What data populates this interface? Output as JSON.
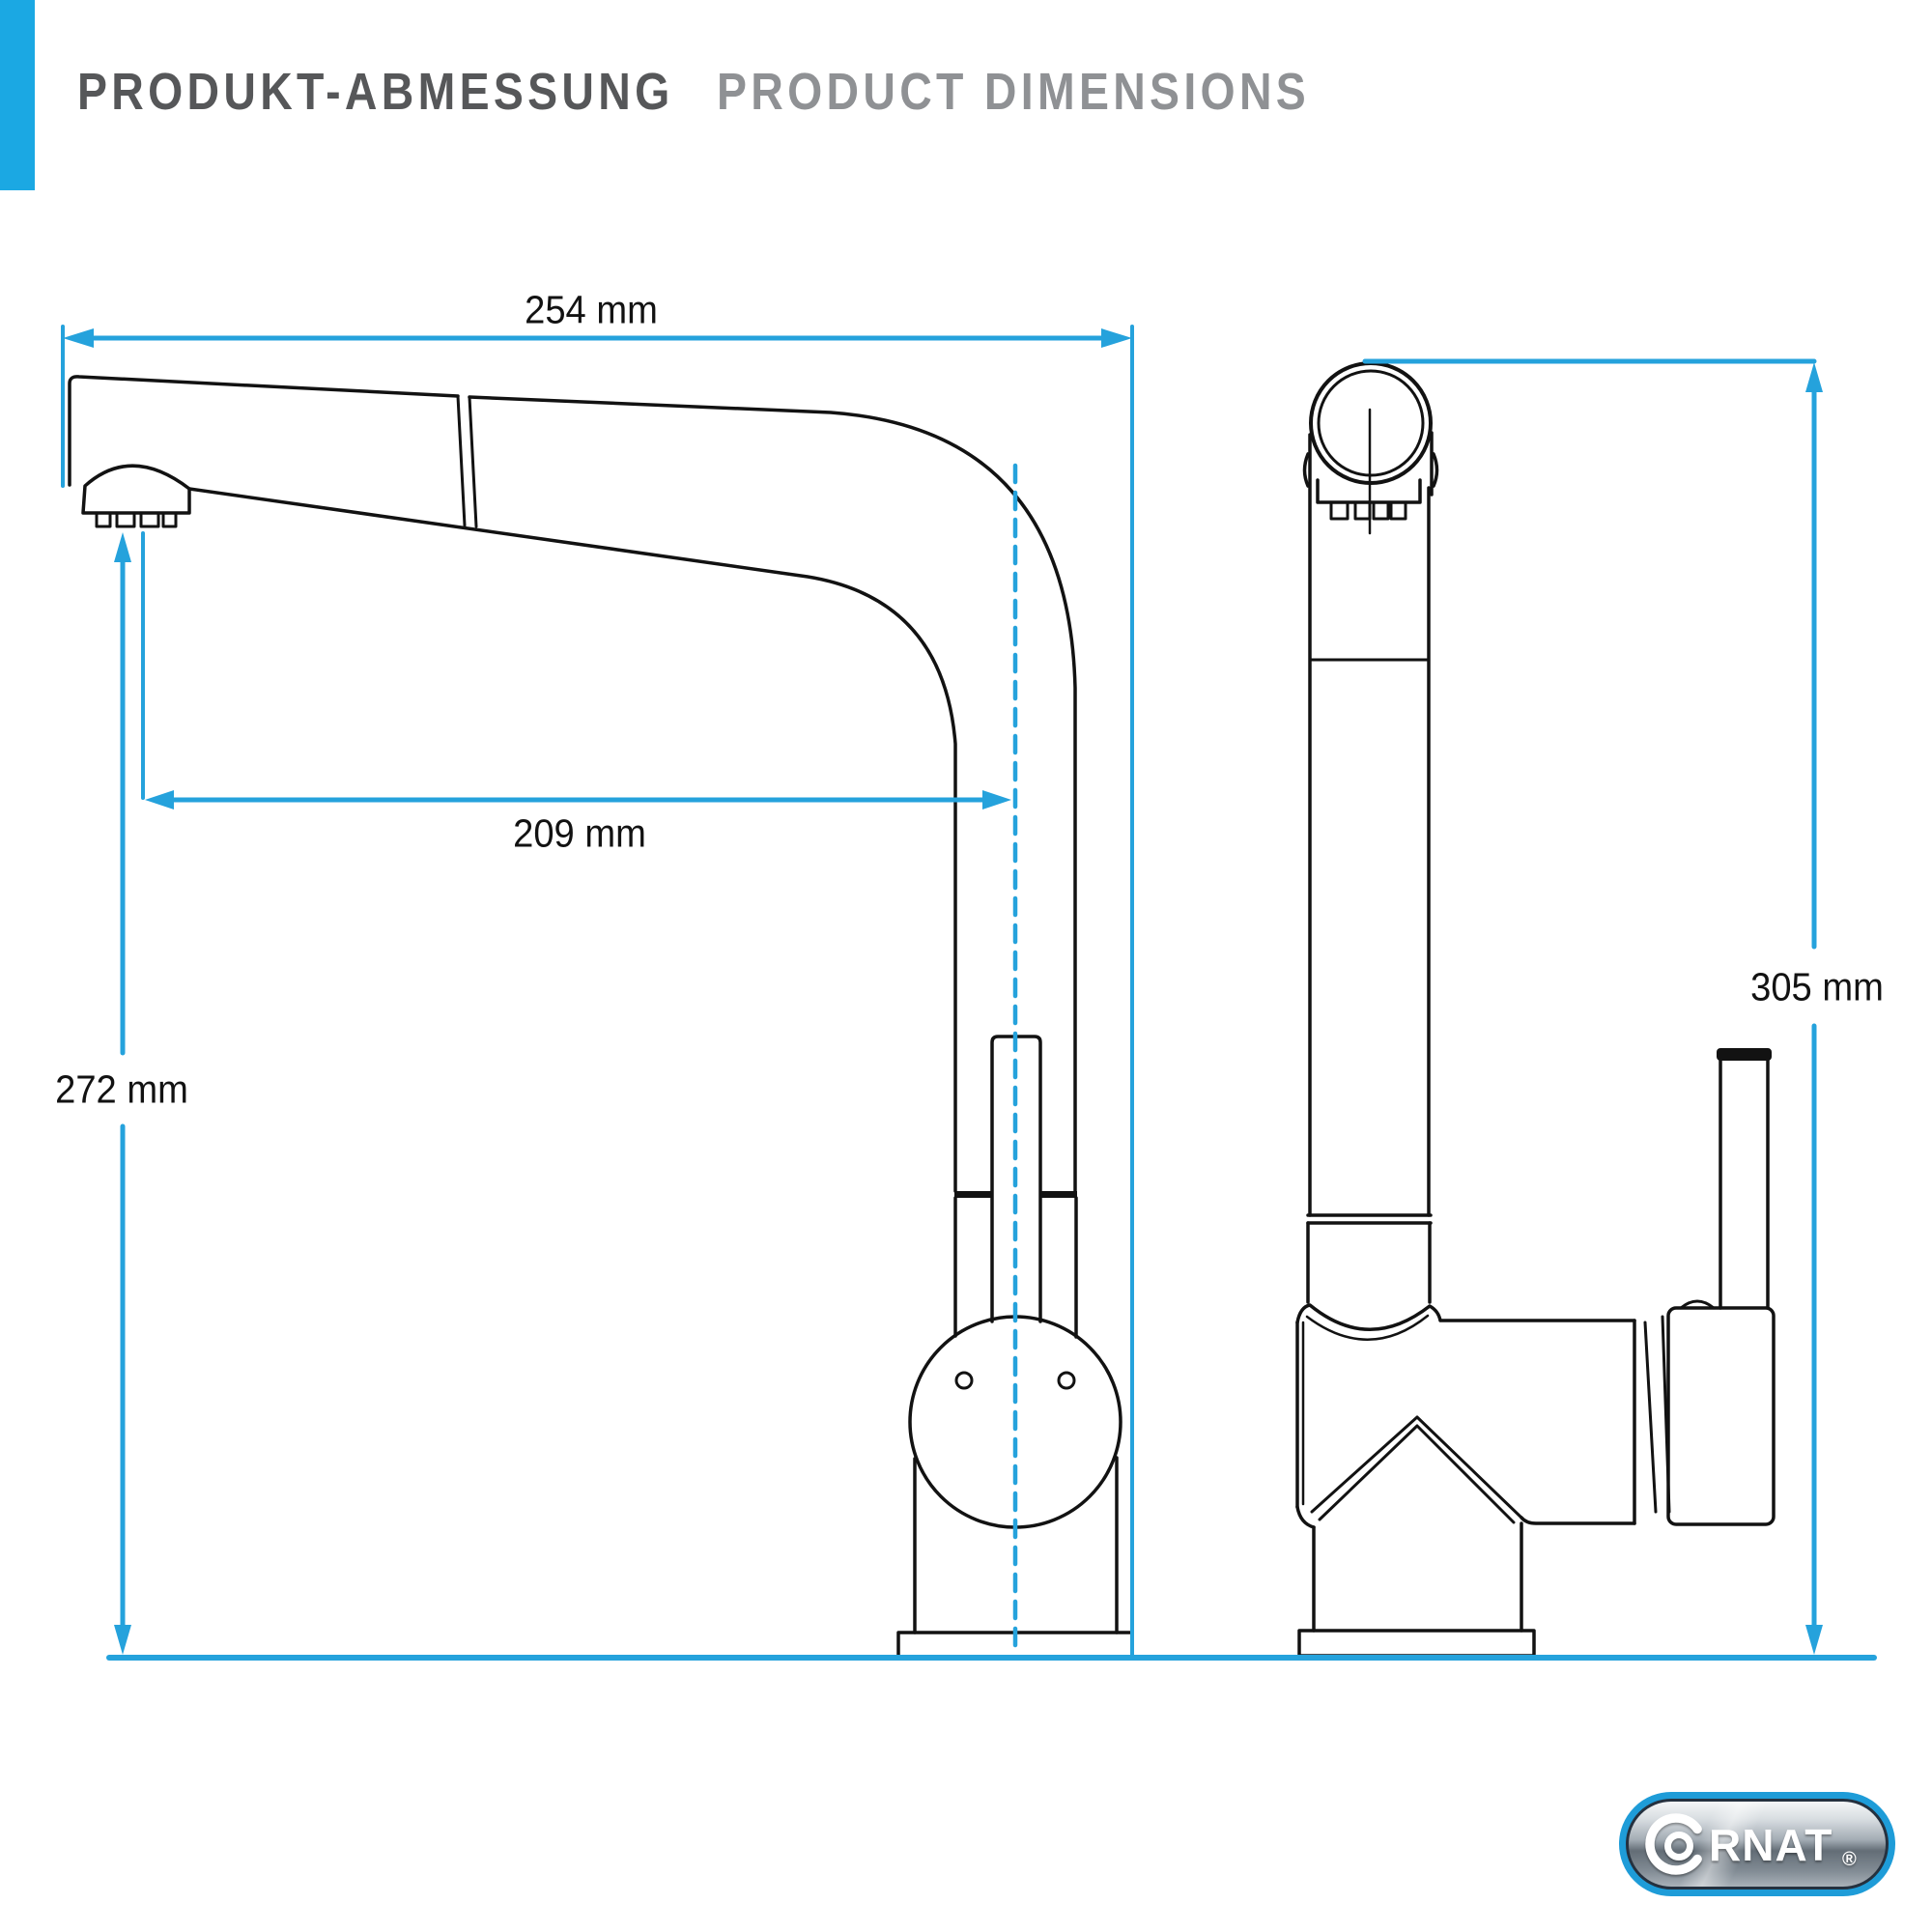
{
  "header": {
    "title_de": "PRODUKT-ABMESSUNG",
    "title_en": "PRODUCT DIMENSIONS"
  },
  "dimensions": {
    "top_width": "254 mm",
    "spout_reach": "209 mm",
    "spout_height": "272 mm",
    "total_height": "305 mm"
  },
  "logo": {
    "brand": "CORNAT",
    "brand_rest": "RNAT",
    "registered": "®"
  },
  "colors": {
    "accent_blue": "#25A2DC",
    "header_bar_blue": "#1BA8E3",
    "ink": "#121212",
    "title_primary": "#565759",
    "title_secondary": "#8F9194",
    "logo_border_blue": "#1E9CD8"
  }
}
